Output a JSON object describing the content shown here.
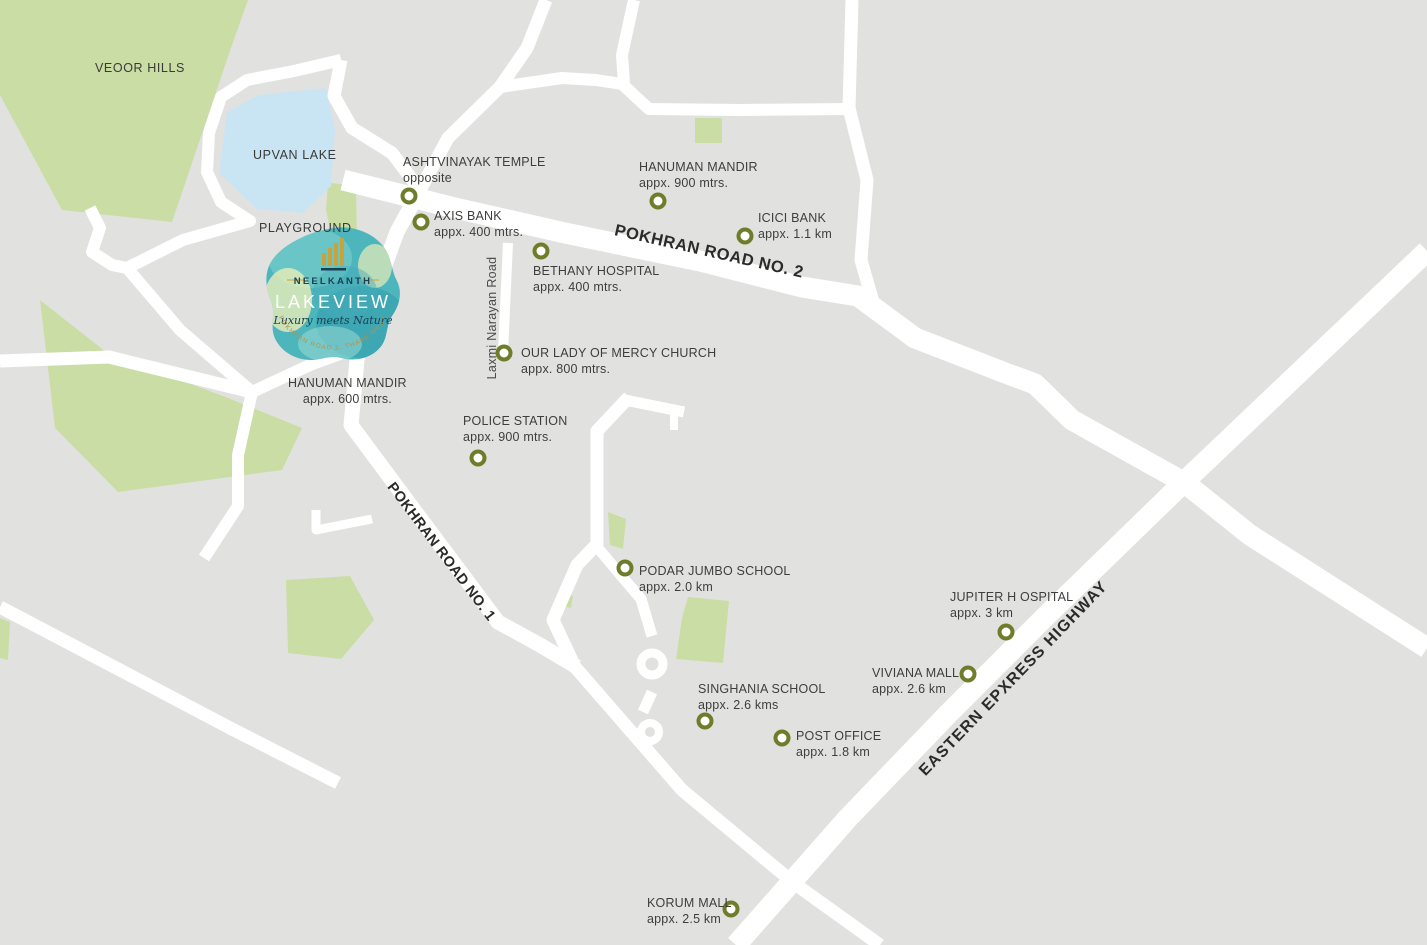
{
  "map": {
    "colors": {
      "background": "#e1e2df",
      "road": "#ffffff",
      "green_area": "#cadda4",
      "lake": "#c9e4f3",
      "marker_ring": "#6f7d2b",
      "label_text": "#3e3e3c",
      "logo_teal": "#4db6bc",
      "logo_navy": "#1a4053",
      "logo_gold": "#c8a33c"
    },
    "marker_style": {
      "shape": "ring",
      "color": "#6f7d2b"
    },
    "areas": {
      "veoor_hills": "VEOOR HILLS",
      "upvan_lake": "UPVAN LAKE",
      "playground": "PLAYGROUND"
    },
    "roads": {
      "pokhran_road_2": "POKHRAN ROAD NO. 2",
      "pokhran_road_1": "POKHRAN ROAD NO. 1",
      "eastern_express_highway": "EASTERN EPXRESS HIGHWAY",
      "laxmi_narayan_road": "Laxmi Narayan Road"
    },
    "logo": {
      "brand": "NEELKANTH",
      "project": "LAKEVIEW",
      "tagline": "Luxury meets Nature",
      "location_arc": "POKHRAN ROAD 2, THANE WEST"
    },
    "pois": [
      {
        "id": "ashtvinayak-temple",
        "name": "ASHTVINAYAK TEMPLE",
        "distance": "opposite"
      },
      {
        "id": "axis-bank",
        "name": "AXIS BANK",
        "distance": "appx. 400 mtrs."
      },
      {
        "id": "bethany-hospital",
        "name": "BETHANY HOSPITAL",
        "distance": "appx. 400 mtrs."
      },
      {
        "id": "hanuman-mandir-north",
        "name": "HANUMAN MANDIR",
        "distance": "appx. 900 mtrs."
      },
      {
        "id": "icici-bank",
        "name": "ICICI BANK",
        "distance": "appx. 1.1 km"
      },
      {
        "id": "our-lady-of-mercy-church",
        "name": "OUR LADY OF MERCY CHURCH",
        "distance": "appx. 800 mtrs."
      },
      {
        "id": "hanuman-mandir-west",
        "name": "HANUMAN MANDIR",
        "distance": "appx. 600 mtrs."
      },
      {
        "id": "police-station",
        "name": "POLICE STATION",
        "distance": "appx. 900 mtrs."
      },
      {
        "id": "podar-jumbo-school",
        "name": "PODAR JUMBO SCHOOL",
        "distance": "appx. 2.0 km"
      },
      {
        "id": "jupiter-hospital",
        "name": "JUPITER H OSPITAL",
        "distance": "appx. 3 km"
      },
      {
        "id": "viviana-mall",
        "name": "VIVIANA MALL",
        "distance": "appx. 2.6 km"
      },
      {
        "id": "singhania-school",
        "name": "SINGHANIA SCHOOL",
        "distance": "appx. 2.6 kms"
      },
      {
        "id": "post-office",
        "name": "POST OFFICE",
        "distance": "appx. 1.8 km"
      },
      {
        "id": "korum-mall",
        "name": "KORUM  MALL",
        "distance": "appx. 2.5 km"
      }
    ]
  }
}
